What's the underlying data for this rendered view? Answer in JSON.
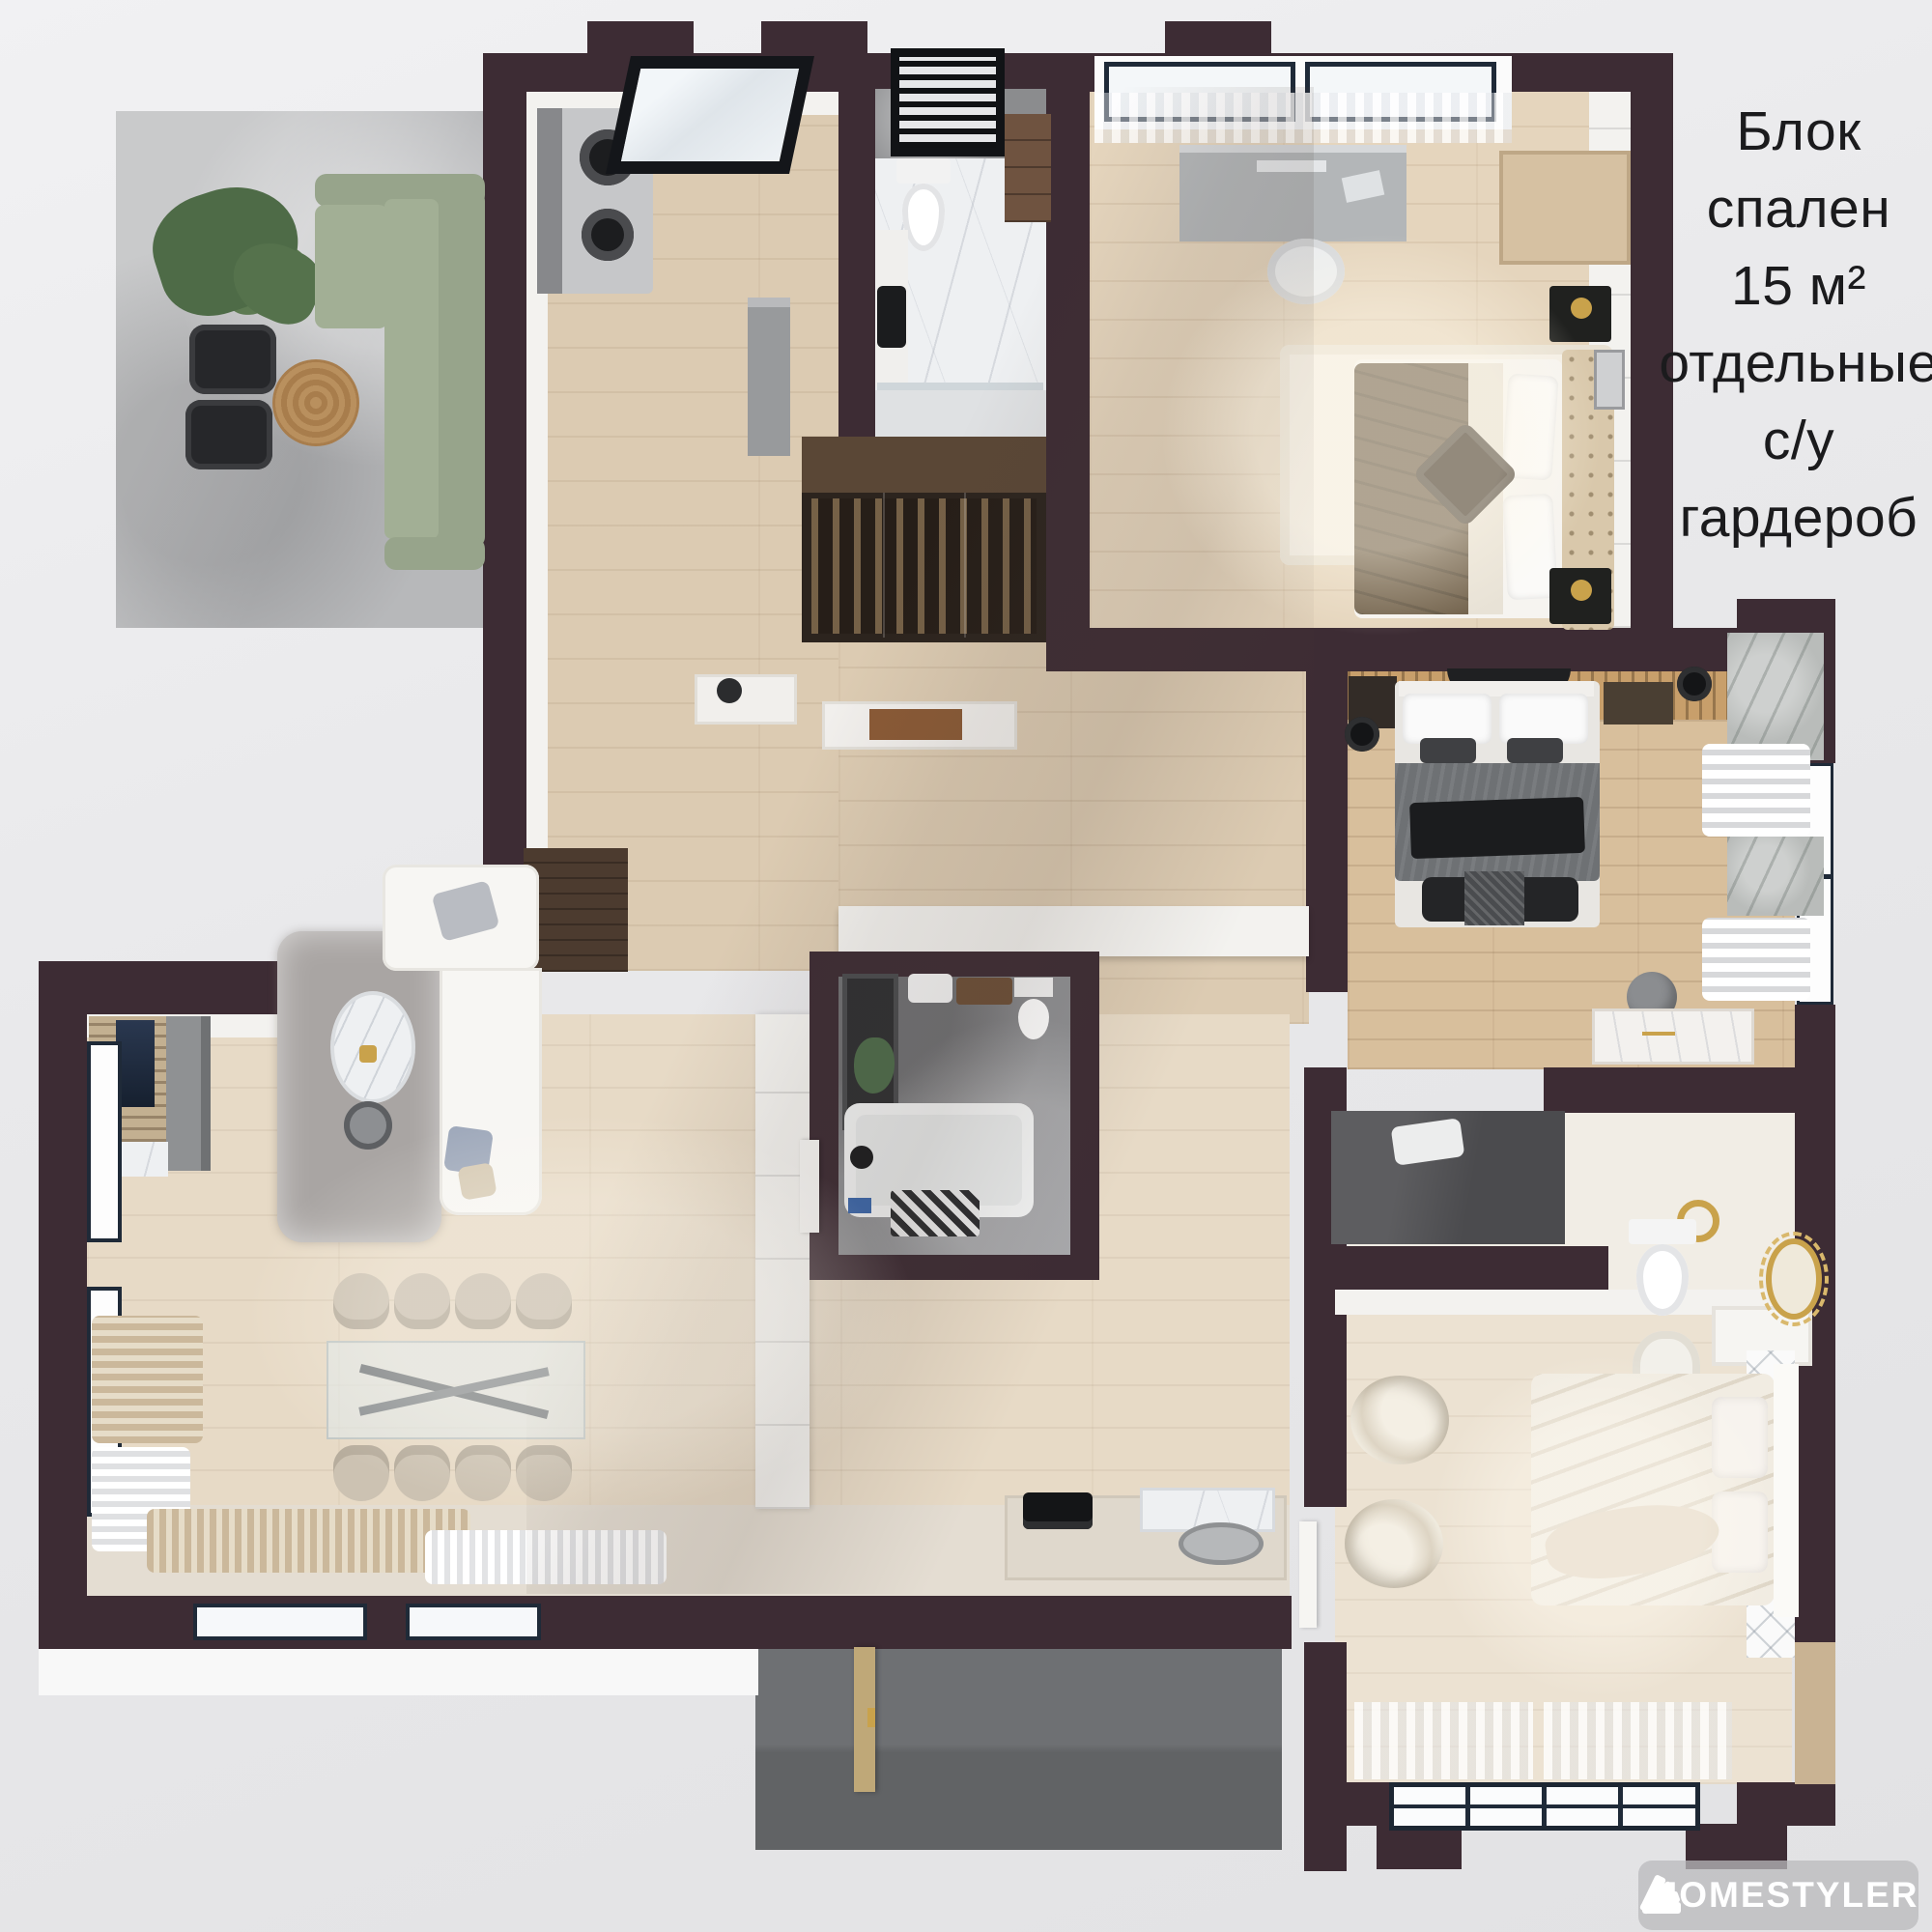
{
  "annotation": {
    "lines": [
      "Блок",
      "спален",
      "15 м²",
      "отдельные",
      "с/у",
      "гардероб"
    ],
    "text": "Блок спален 15 м² отдельные с/у гардероб"
  },
  "watermark": {
    "brand": "HOMESTYLER",
    "icon": "fan-swatch-icon"
  },
  "palette": {
    "background": "#e9e9eb",
    "wall": "#3d2c34",
    "wall_face_white": "#f3f2ef",
    "wood_floor": "#dccbb2",
    "wood_floor_light": "#e5d5bd",
    "wood_floor_living": "#e7dac6",
    "wood_floor_warm": "#d8bf9c",
    "wood_floor_pale": "#ece2d2",
    "terrace_concrete": "#b7b8ba",
    "terrace_dark": "#67696c",
    "marble": "#eef0f2",
    "bath_concrete": "#8f9093",
    "sofa_green": "#9aa78f",
    "accent_gold": "#c9a24b",
    "frame_navy": "#1f2a38",
    "text_color": "#1b1b1d",
    "watermark_bg": "#c7c7c9",
    "watermark_text": "#ffffff"
  }
}
